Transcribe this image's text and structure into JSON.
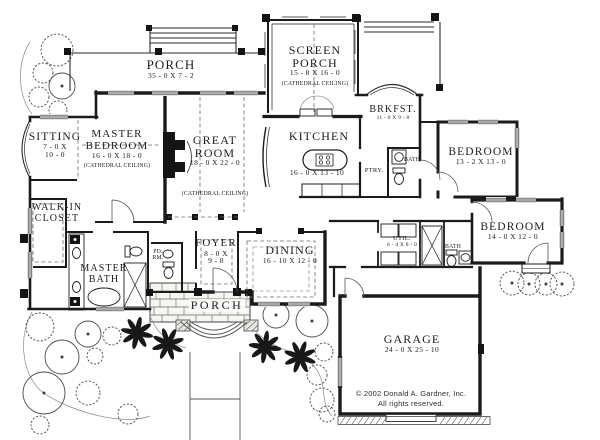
{
  "drawing": {
    "type": "house floor plan",
    "colors": {
      "ink": "#1b1b1b",
      "paper": "#ffffff"
    }
  },
  "rooms": {
    "porch_top": {
      "name": "PORCH",
      "dims": "35 - 0 X 7 - 2"
    },
    "screen_porch": {
      "line1": "SCREEN",
      "line2": "PORCH",
      "dims": "15 - 8 X 16 - 0",
      "note": "(CATHEDRAL CEILING)"
    },
    "sitting": {
      "name": "SITTING",
      "dims1": "7 - 0 X",
      "dims2": "10 - 0"
    },
    "master_bedroom": {
      "line1": "MASTER",
      "line2": "BEDROOM",
      "dims": "16 - 0 X 18 - 0",
      "note": "(CATHEDRAL CEILING)"
    },
    "great_room": {
      "line1": "GREAT",
      "line2": "ROOM",
      "dims": "18 - 0 X 22 - 0",
      "note": "(CATHEDRAL CEILING)"
    },
    "kitchen": {
      "name": "KITCHEN",
      "dims": "16 - 0 X 13 - 10"
    },
    "brkfst": {
      "name": "BRKFST.",
      "dims": "11 - 0 X 9 - 8"
    },
    "ptry": {
      "name": "PTRY."
    },
    "bath_upper": {
      "name": "BATH"
    },
    "bedroom_top": {
      "name": "BEDROOM",
      "dims": "13 - 2 X 13 - 0"
    },
    "bedroom_bottom": {
      "name": "BEDROOM",
      "dims": "14 - 0 X 12 - 0"
    },
    "walk_in_closet": {
      "line1": "WALK-IN",
      "line2": "CLOSET"
    },
    "master_bath": {
      "line1": "MASTER",
      "line2": "BATH"
    },
    "pd_rm": {
      "line1": "PD.",
      "line2": "RM."
    },
    "foyer": {
      "name": "FOYER",
      "dims1": "8 - 0 X",
      "dims2": "9 - 8"
    },
    "dining": {
      "name": "DINING",
      "dims": "16 - 10 X 12 - 0"
    },
    "util": {
      "name": "UTIL.",
      "dims": "6 - 4 X 8 - 0"
    },
    "bath_lower": {
      "name": "BATH"
    },
    "porch_bottom": {
      "name": "PORCH"
    },
    "garage": {
      "name": "GARAGE",
      "dims": "24 - 0 X 25 - 10"
    }
  },
  "copyright": {
    "line1": "© 2002 Donald A. Gardner, Inc.",
    "line2": "All rights reserved."
  }
}
